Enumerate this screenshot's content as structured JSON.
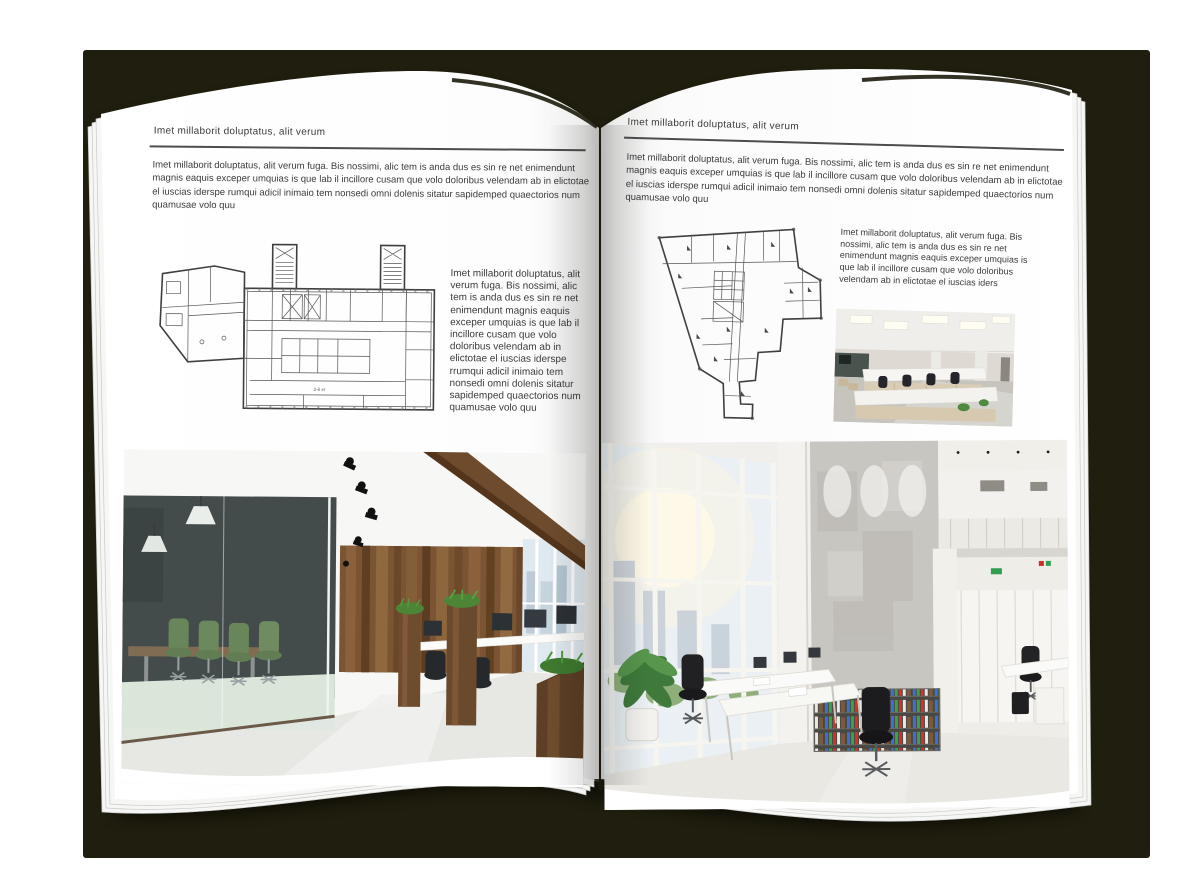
{
  "canvas": {
    "backdrop_color": "#201e0e",
    "page_color": "#ffffff",
    "text_color": "#3b3b3b"
  },
  "left_page": {
    "header": "Imet millaborit doluptatus, alit verum",
    "intro": "Imet millaborit doluptatus, alit verum fuga. Bis nossimi, alic tem is anda dus es sin re net enimendunt magnis eaquis exceper umquias is que lab il incillore cusam que volo doloribus velendam ab in elictotae el iuscias iderspe rumqui adicil inimaio tem nonsedi omni dolenis sitatur sapidemped quaectorios num quamusae volo quu",
    "plan_caption": "2-й эт",
    "side_text": "Imet millaborit doluptatus, alit verum fuga. Bis nossimi, alic tem is anda dus es sin re net enimendunt magnis eaquis exceper umquias is que lab il incillore cusam que volo doloribus velendam ab in elictotae el iuscias iderspe rrumqui adicil inimaio tem nonsedi omni dolenis sitatur sapidemped quaectorios num quamusae volo quu"
  },
  "right_page": {
    "header": "Imet millaborit doluptatus, alit verum",
    "intro": "Imet millaborit doluptatus, alit verum fuga. Bis nossimi, alic tem is anda dus es sin re net enimendunt magnis eaquis exceper umquias is que lab il incillore cusam que volo doloribus velendam ab in elictotae el iuscias iderspe rumqui adicil inimaio tem nonsedi omni dolenis sitatur sapidemped quaectorios num quamusae volo quu",
    "side_text": "Imet millaborit doluptatus, alit verum fuga. Bis nossimi, alic tem is anda dus es sin re net enimendunt magnis eaquis exceper umquias is que lab il incillore cusam que volo doloribus velendam ab in elictotae el iuscias iders"
  }
}
